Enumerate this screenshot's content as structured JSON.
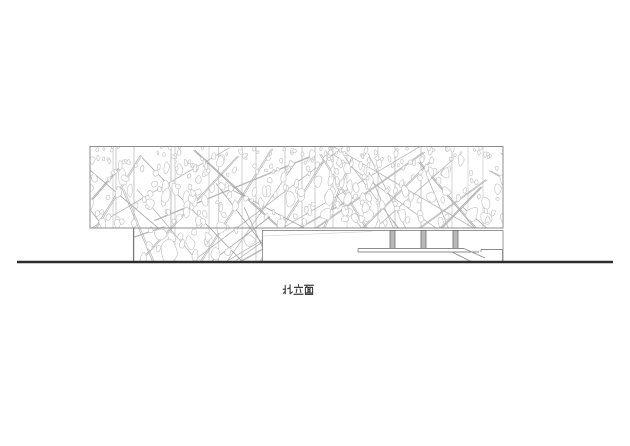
{
  "drawing": {
    "title_label": "北立面",
    "colors": {
      "background": "#ffffff",
      "outline": "#8c8c8c",
      "outline_dark": "#7b7b7b",
      "pattern_diagonal": "#b6b6b6",
      "pattern_diagonal_dark": "#a2a2a2",
      "pattern_joint": "#b0b0b0",
      "pattern_blob": "#c8c8c8",
      "column_fill": "#b9b9b9",
      "column_edge": "#6e6e6e",
      "ground": "#2d2d2d",
      "faint_line": "#d9d9d9",
      "label_text": "#3c3c3c"
    },
    "geometry": {
      "canvas": {
        "w": 630,
        "h": 446
      },
      "main_volume": {
        "x": 90,
        "y": 146.5,
        "w": 413,
        "h": 81.5
      },
      "podium": {
        "x": 133.5,
        "y": 228,
        "w": 129,
        "h": 33.5
      },
      "entry_wall": {
        "x": 262.5,
        "y": 230.5,
        "w": 240.5,
        "h": 31.5
      },
      "entry_wall_faint_line": {
        "x1": 263,
        "y1": 236,
        "x2": 372,
        "y2": 231.5
      },
      "columns": {
        "centers_x": [
          392.5,
          423.5,
          455.5
        ],
        "width": 5,
        "y_top": 230.5,
        "y_bottom": 248.5
      },
      "platform": {
        "top_line": {
          "x1": 358,
          "y1": 248.5,
          "x2": 464,
          "y2": 248.5
        },
        "mid_line": {
          "x1": 358,
          "y1": 252,
          "x2": 479,
          "y2": 252
        },
        "left_edge": {
          "x1": 358,
          "y1": 248.5,
          "x2": 358,
          "y2": 252
        },
        "ramp_upper": {
          "x1": 464,
          "y1": 248.5,
          "x2": 485,
          "y2": 258
        },
        "ramp_lower": {
          "x1": 452,
          "y1": 252,
          "x2": 471,
          "y2": 261.5
        },
        "landing_top": {
          "x1": 481,
          "y1": 249.5,
          "x2": 502.5,
          "y2": 249.5
        },
        "landing_left": {
          "x1": 481,
          "y1": 249.5,
          "x2": 481,
          "y2": 252
        },
        "landing_right": {
          "x1": 502.5,
          "y1": 249.5,
          "x2": 502.5,
          "y2": 261.5
        }
      },
      "ground_line": {
        "x1": 17,
        "y1": 262,
        "x2": 613,
        "y2": 262,
        "width": 2.4
      },
      "label": {
        "x": 283,
        "y": 284,
        "char_advance": 10.5,
        "char_w": 10,
        "char_h": 11.4
      }
    },
    "facade_pattern": {
      "seed": 20240613,
      "blob_count": 520,
      "diagonal_count": 44,
      "joint_xs": [
        113,
        116,
        134,
        171,
        175,
        209,
        218.5,
        242,
        256,
        285,
        302,
        315,
        333,
        347,
        378,
        395,
        421,
        452,
        468,
        483
      ]
    }
  }
}
